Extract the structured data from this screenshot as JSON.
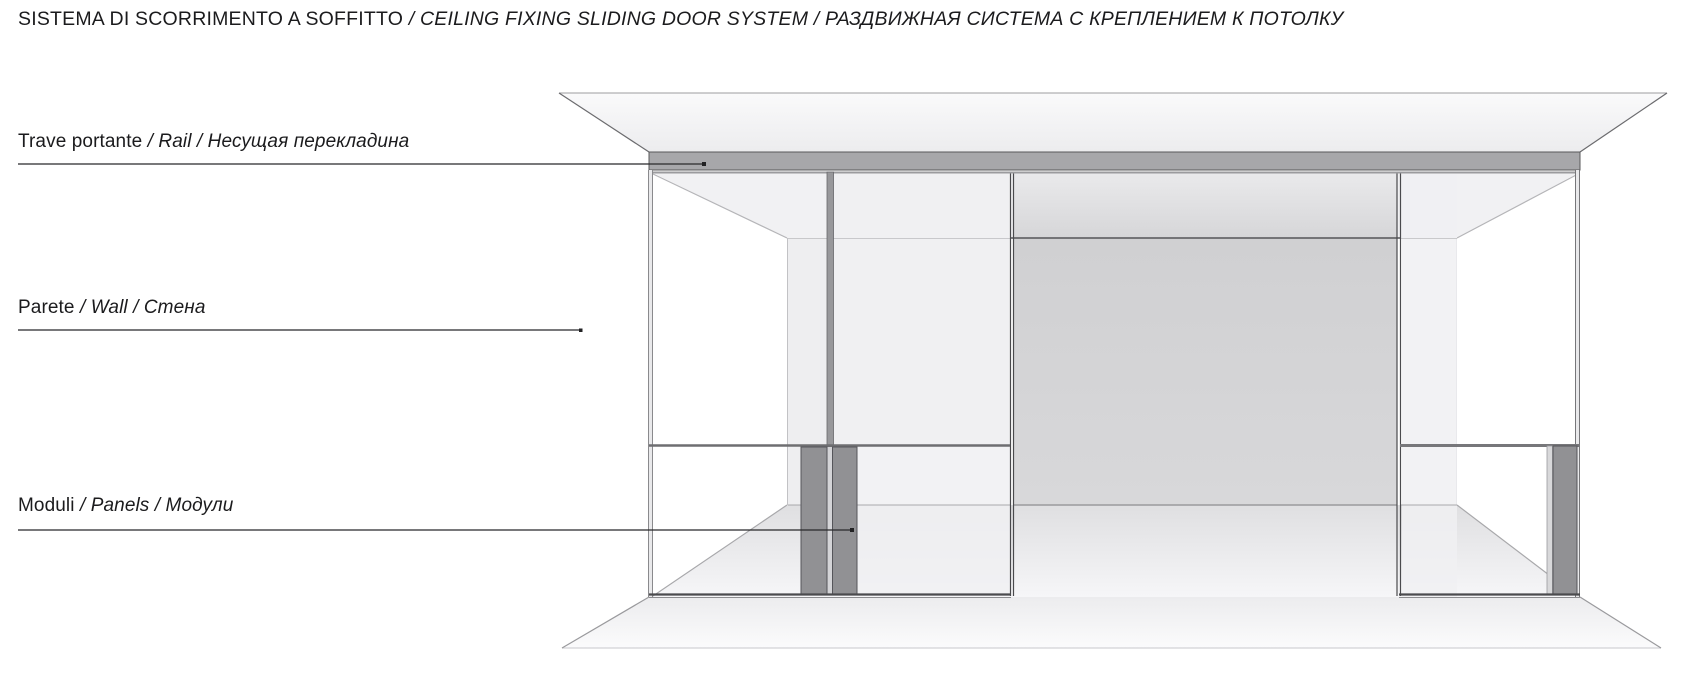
{
  "title": {
    "primary": "SISTEMA DI SCORRIMENTO A SOFFITTO",
    "secondary": " / CEILING FIXING SLIDING DOOR SYSTEM / РАЗДВИЖНАЯ СИСТЕМА С КРЕПЛЕНИЕМ К ПОТОЛКУ"
  },
  "labels": [
    {
      "id": "rail",
      "primary": "Trave portante",
      "secondary": " / Rail / Несущая перекладина"
    },
    {
      "id": "wall",
      "primary": "Parete",
      "secondary": " / Wall / Стена"
    },
    {
      "id": "panels",
      "primary": "Moduli",
      "secondary": " / Panels / Модули"
    }
  ],
  "colors": {
    "text": "#1b1b1d",
    "leader_line": "#28282a",
    "rail_gray": "#a7a7aa",
    "post_gray": "#98989b",
    "module_gray": "#919194",
    "back_wall_gray": "#d3d3d5",
    "panel_light": "#f0f0f2",
    "interior_ceiling": "#f1f1f3",
    "line_dark": "#4b4b4e",
    "line_mid": "#77777a",
    "line_faint": "#b8b8bb"
  }
}
